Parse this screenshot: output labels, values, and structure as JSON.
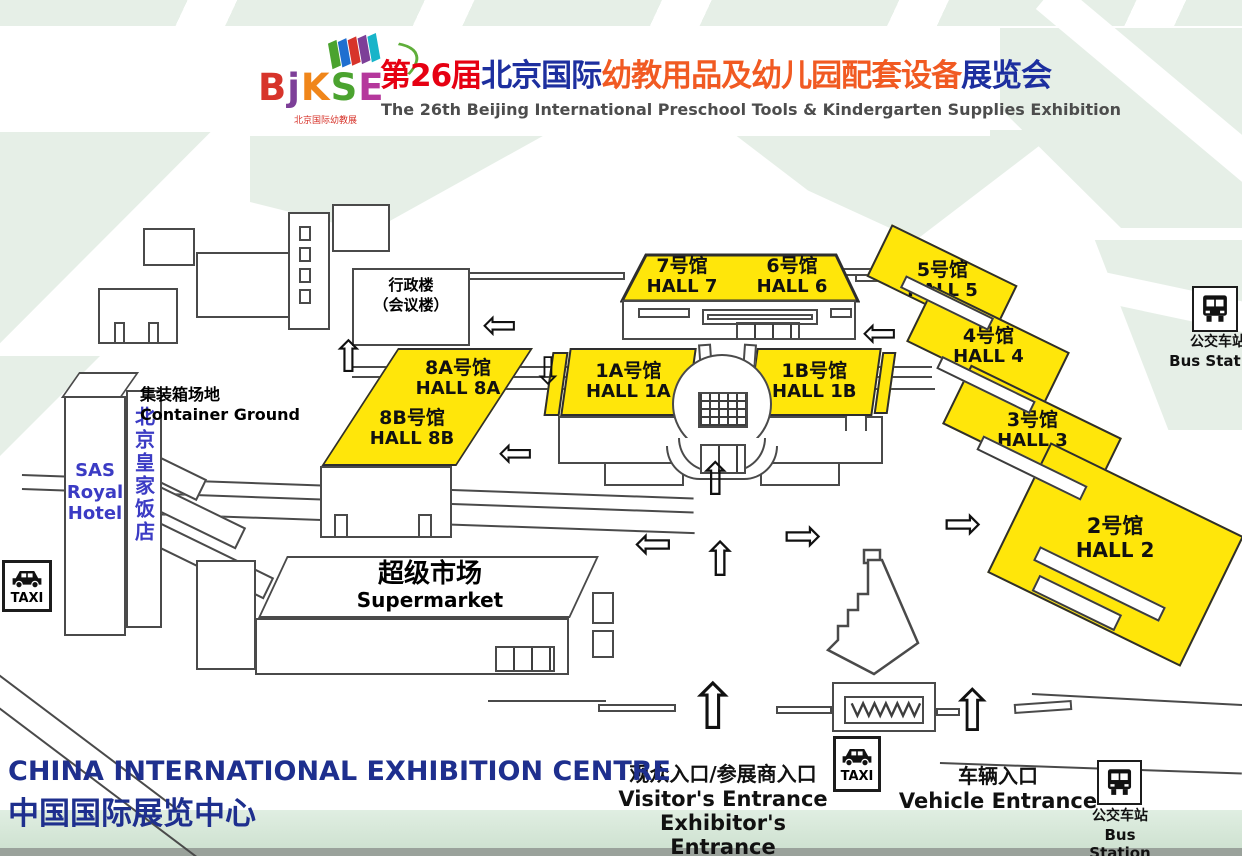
{
  "header": {
    "logo": {
      "letters": [
        {
          "ch": "B",
          "color": "#d7342b"
        },
        {
          "ch": "j",
          "color": "#7d3f98"
        },
        {
          "ch": "K",
          "color": "#f0861a"
        },
        {
          "ch": "S",
          "color": "#4ba32f"
        },
        {
          "ch": "E",
          "color": "#b5389c"
        }
      ],
      "tagline": "北京国际幼教展",
      "swoosh_color": "#5fae3a"
    },
    "title_parts": [
      {
        "text": "第26届",
        "color": "#e60012"
      },
      {
        "text": "北京国际",
        "color": "#1d2f9f"
      },
      {
        "text": "幼教用品及幼儿园配套设备",
        "color": "#f15a22"
      },
      {
        "text": "展览会",
        "color": "#1d2f9f"
      }
    ],
    "subtitle": "The 26th Beijing International Preschool Tools & Kindergarten Supplies Exhibition"
  },
  "map": {
    "halls": [
      {
        "cn": "7号馆",
        "en": "HALL 7"
      },
      {
        "cn": "6号馆",
        "en": "HALL 6"
      },
      {
        "cn": "5号馆",
        "en": "HALL 5"
      },
      {
        "cn": "4号馆",
        "en": "HALL 4"
      },
      {
        "cn": "3号馆",
        "en": "HALL 3"
      },
      {
        "cn": "2号馆",
        "en": "HALL 2"
      },
      {
        "cn": "1A号馆",
        "en": "HALL 1A"
      },
      {
        "cn": "1B号馆",
        "en": "HALL 1B"
      },
      {
        "cn": "8A号馆",
        "en": "HALL 8A"
      },
      {
        "cn": "8B号馆",
        "en": "HALL 8B"
      }
    ],
    "buildings": {
      "admin_l1": "行政楼",
      "admin_l2": "（会议楼）",
      "container_cn": "集装箱场地",
      "container_en": "Container Ground",
      "hotel_en": "SAS Royal Hotel",
      "hotel_cn": "北京皇家饭店",
      "super_cn": "超级市场",
      "super_en": "Supermarket"
    },
    "signs": {
      "taxi": "TAXI",
      "bus_cn": "公交车站",
      "bus_en": "Bus Station"
    },
    "entrances": {
      "visitor_cn": "观众入口/参展商入口",
      "visitor_en": "Visitor's Entrance",
      "exhibitor_en": "Exhibitor's Entrance",
      "vehicle_cn": "车辆入口",
      "vehicle_en": "Vehicle Entrance"
    },
    "icons": {
      "up": "⇧",
      "down": "⇩",
      "left": "⇦",
      "right": "⇨"
    }
  },
  "footer": {
    "venue_en": "CHINA INTERNATIONAL EXHIBITION CENTRE",
    "venue_cn": "中国国际展览中心"
  },
  "colors": {
    "hall_fill": "#ffe60a",
    "map_outline": "#3d3d3d",
    "venue_text": "#1e2f8e",
    "green_bg": "#e6efe7",
    "hotel_text": "#3b3bc4"
  }
}
